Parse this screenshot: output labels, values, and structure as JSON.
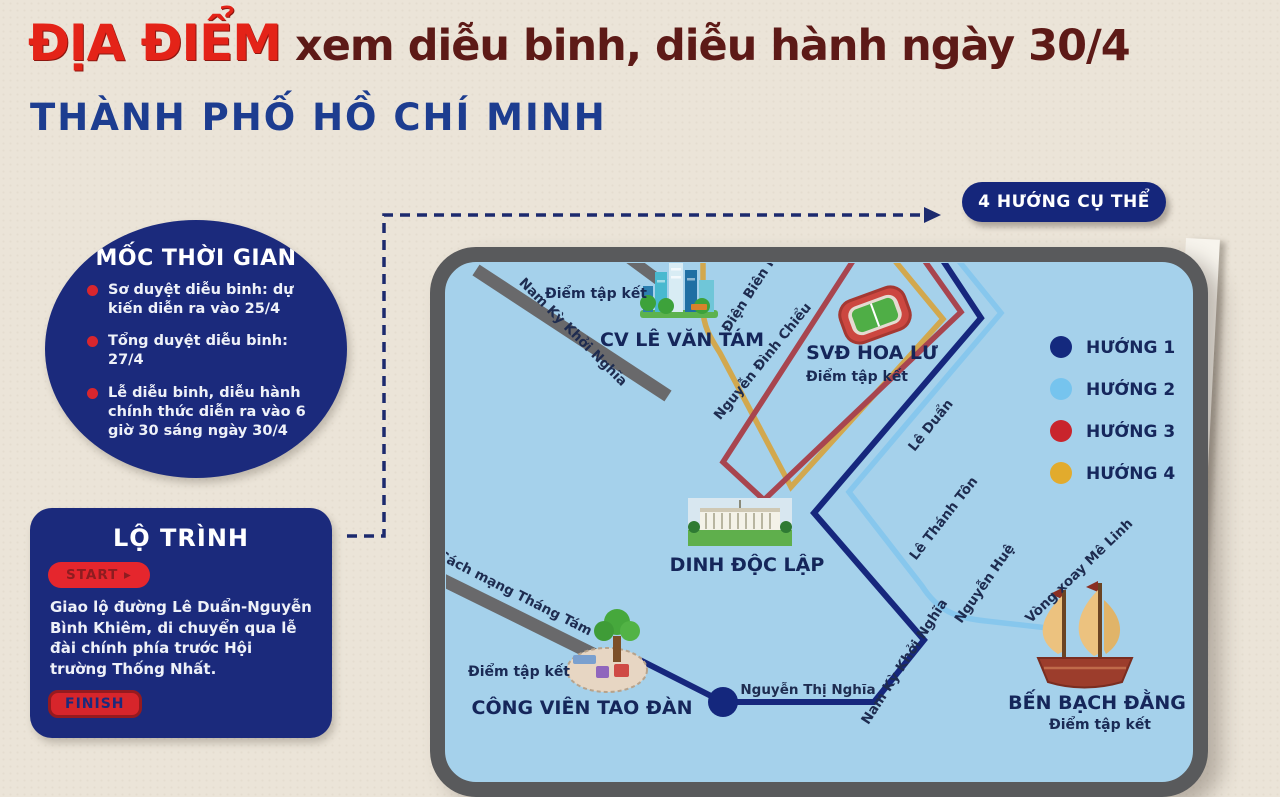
{
  "header": {
    "title_highlight": "ĐỊA ĐIỂM",
    "title_rest": "xem diễu binh, diễu hành ngày 30/4",
    "subtitle": "THÀNH PHỐ HỒ CHÍ MINH"
  },
  "timeline": {
    "title": "MỐC THỜI GIAN",
    "items": [
      "Sơ duyệt diễu binh: dự kiến diễn ra vào 25/4",
      "Tổng duyệt diễu binh: 27/4",
      "Lễ diễu binh, diễu hành chính thức diễn ra vào 6 giờ 30 sáng ngày 30/4"
    ]
  },
  "route_card": {
    "title": "LỘ TRÌNH",
    "start_label": "START ▸",
    "description": "Giao lộ đường Lê Duẩn-Nguyễn Bình Khiêm, di chuyển qua lễ đài chính phía trước Hội trường Thống Nhất.",
    "finish_label": "FINISH"
  },
  "directions_pill": "4 HƯỚNG CỤ THỂ",
  "map": {
    "legend": [
      {
        "label": "HƯỚNG 1",
        "color": "#14297e"
      },
      {
        "label": "HƯỚNG 2",
        "color": "#76c4ee"
      },
      {
        "label": "HƯỚNG 3",
        "color": "#c9242c"
      },
      {
        "label": "HƯỚNG 4",
        "color": "#e2ab2d"
      }
    ],
    "routes": [
      {
        "name": "huong-1",
        "color": "#16277d"
      },
      {
        "name": "huong-2",
        "color": "#87c7ed"
      },
      {
        "name": "huong-3",
        "color": "#a8454f"
      },
      {
        "name": "huong-4",
        "color": "#d2a84e"
      }
    ],
    "landmarks": [
      {
        "name": "CV LÊ VĂN TÁM",
        "note": "Điểm tập kết"
      },
      {
        "name": "SVĐ HOA LƯ",
        "note": "Điểm tập kết"
      },
      {
        "name": "DINH ĐỘC LẬP",
        "note": ""
      },
      {
        "name": "CÔNG VIÊN TAO ĐÀN",
        "note": "Điểm tập kết"
      },
      {
        "name": "BẾN BẠCH ĐẰNG",
        "note": "Điểm tập kết"
      }
    ],
    "streets": [
      {
        "label": "Nam Kỳ Khởi Nghĩa"
      },
      {
        "label": "Điện Biên Phủ"
      },
      {
        "label": "Nguyễn Đình Chiểu"
      },
      {
        "label": "Lê Duẩn"
      },
      {
        "label": "Lê Thánh Tôn"
      },
      {
        "label": "Nguyễn Huệ"
      },
      {
        "label": "Vòng xoay Mê Linh"
      },
      {
        "label": "Cách mạng Tháng Tám"
      },
      {
        "label": "Nguyễn Thị Nghĩa"
      },
      {
        "label": "Nam Kỳ Khởi Nghĩa"
      }
    ]
  }
}
